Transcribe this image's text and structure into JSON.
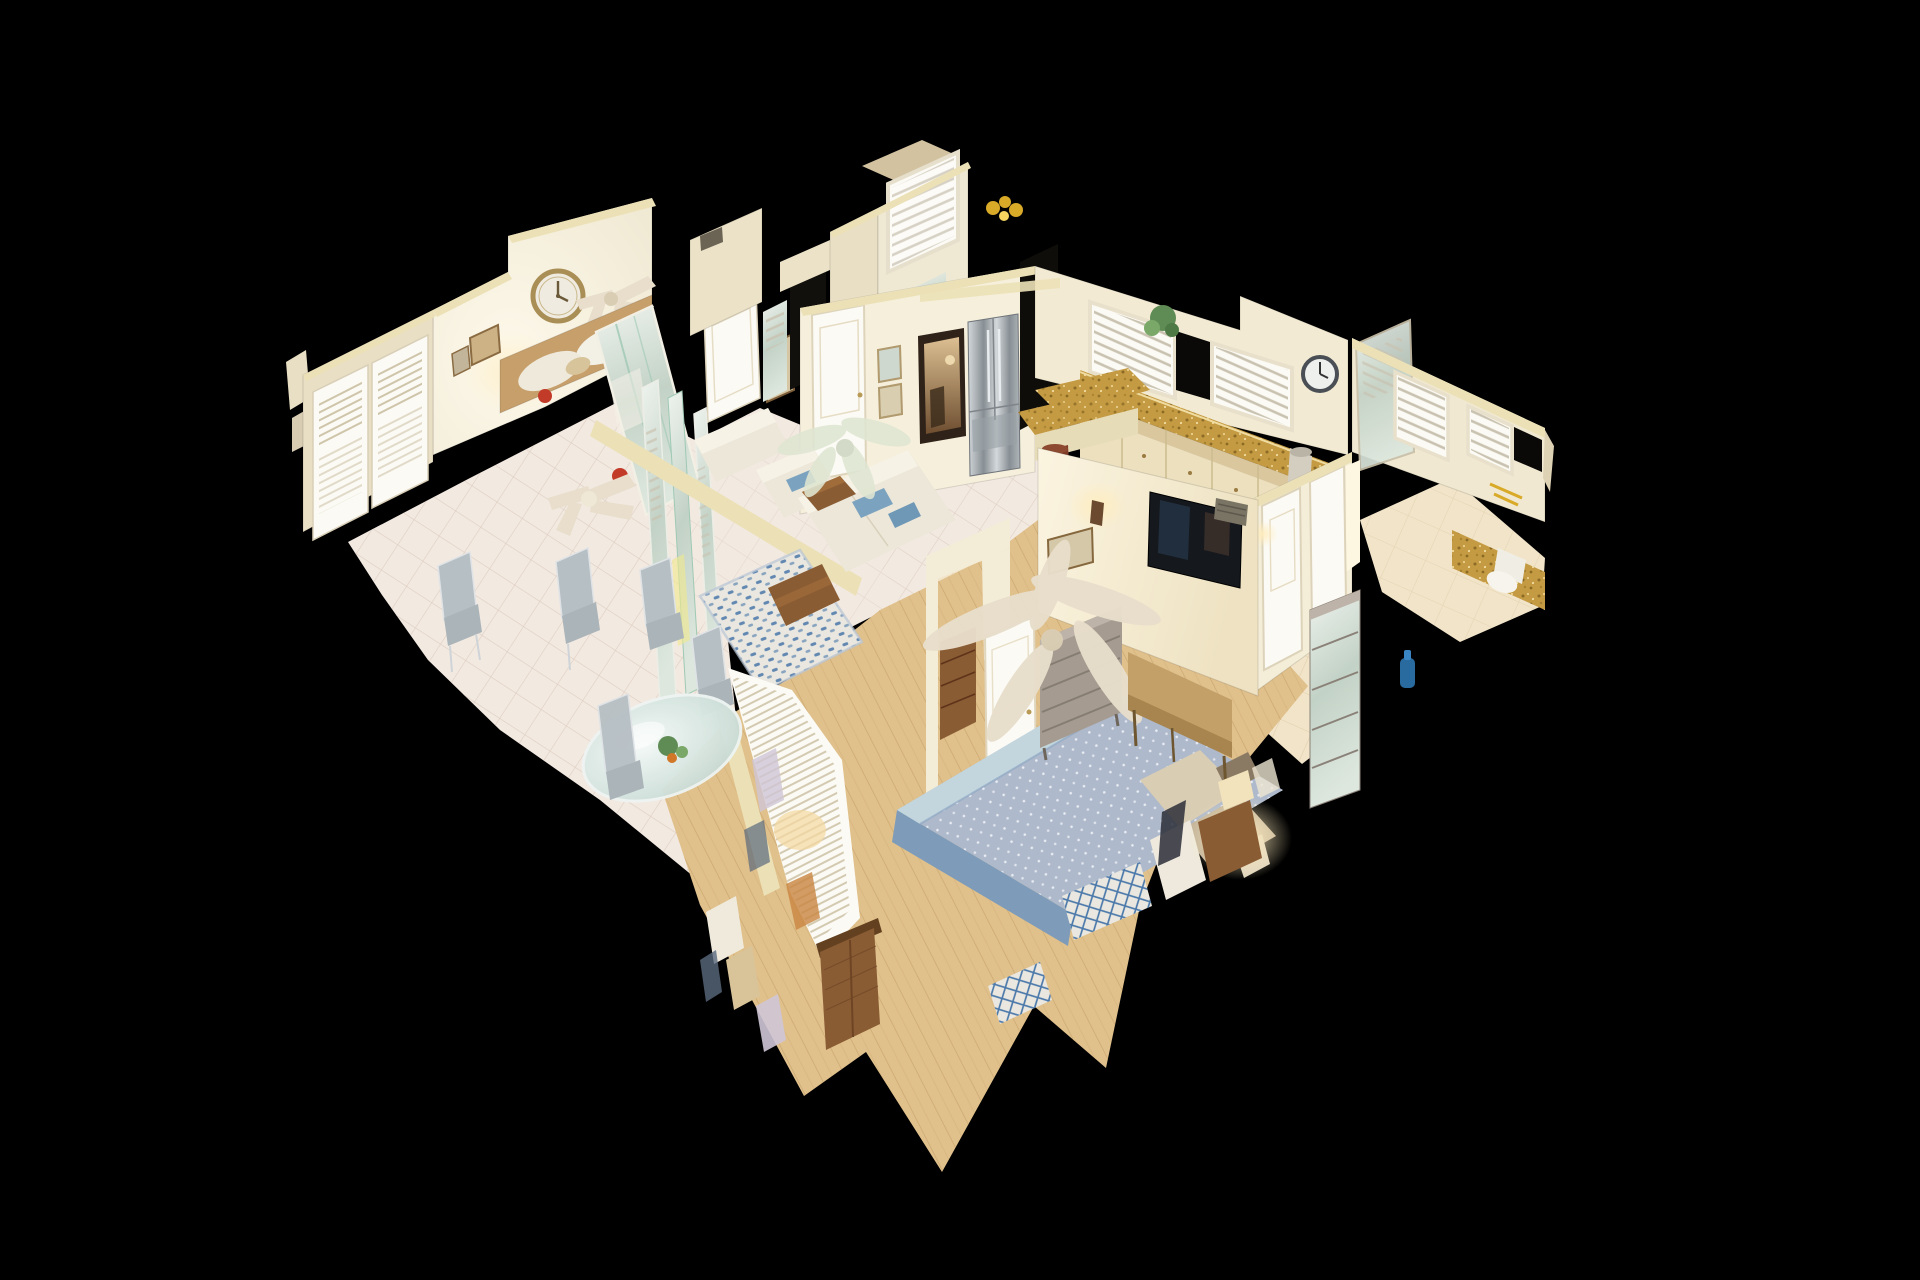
{
  "scene": {
    "label": "3D dollhouse cutaway view of a furnished condo scan on black background",
    "view_mode": "dollhouse",
    "rooms": [
      {
        "name": "guest-bedroom",
        "items": [
          "gold-rim-wall-clock",
          "ceiling-fan-fragment",
          "wood-headboard-with-pillows",
          "louvered-closet-doors",
          "mirrored-closet-panels",
          "framed-art",
          "white-door",
          "red-cardinal-ornament"
        ]
      },
      {
        "name": "dining-area",
        "items": [
          "glass-dining-table",
          "gray-dining-chairs",
          "tile-floor",
          "mirrored-wall-strips",
          "white-ceiling-fan",
          "red-cardinal-ornament"
        ]
      },
      {
        "name": "living-room",
        "items": [
          "white-sofa",
          "white-loveseat",
          "white-armchair",
          "blue-throw-pillows",
          "wood-coffee-table",
          "wood-side-table",
          "blue-pattern-area-rug",
          "glass-ceiling-fan"
        ]
      },
      {
        "name": "entry-hall",
        "items": [
          "white-door",
          "framed-beach-art",
          "ornate-framed-mirror",
          "stainless-french-door-refrigerator",
          "dark-doorway"
        ]
      },
      {
        "name": "guest-bathroom",
        "items": [
          "plantation-shutter-window",
          "vanity-mirror",
          "gold-glassware"
        ]
      },
      {
        "name": "kitchen",
        "items": [
          "plantation-shutter-windows",
          "potted-plant",
          "wall-clock",
          "granite-countertop",
          "cream-cabinets",
          "granite-breakfast-bar",
          "wood-bar-stool",
          "trash-can"
        ]
      },
      {
        "name": "master-bedroom",
        "items": [
          "bed-with-blue-diamond-quilt",
          "blue-bed-skirt",
          "beige-ceiling-fan",
          "weathered-gray-dresser",
          "tan-upholstered-bench",
          "wall-mounted-tv",
          "wall-sconce",
          "air-vent",
          "framed-art",
          "nightstand-with-lamp",
          "wicker-armoire",
          "trellis-rug-fragments",
          "torn-plantation-shutters",
          "wood-plank-floor",
          "white-door",
          "brown-chest-through-doorway"
        ]
      },
      {
        "name": "hallway",
        "items": [
          "white-doors",
          "tall-gray-cabinet",
          "beige-tile-floor",
          "wall-sconce"
        ]
      },
      {
        "name": "master-bathroom",
        "items": [
          "plantation-shutter-windows",
          "shower-glass-panel",
          "granite-vanity",
          "toilet",
          "gold-fixture",
          "blue-water-jug"
        ]
      }
    ]
  },
  "palette": {
    "bg": "#000000",
    "void": "#0d0b08",
    "wall": "#f5efdd",
    "wall_shadow": "#e9dfc4",
    "wall_cap": "#ece1b6",
    "wall_warm": "#fbf4e0",
    "tile": "#f2e9e1",
    "tile_line": "#dccbbd",
    "hall_tile": "#f1e4c9",
    "hall_tile_line": "#ddc9a3",
    "wood": "#e0c08b",
    "wood_line": "#c49f66",
    "granite": "#c49a42",
    "granite_dark": "#8a6a24",
    "granite_light": "#f0dca0",
    "cabinet": "#ece0bf",
    "cabinet_line": "#cdbc8e",
    "steel_hi": "#d3d8db",
    "steel_lo": "#888f94",
    "sofa": "#ece7d8",
    "sofa_hi": "#f6f2e6",
    "pillow_blue": "#7ba3bf",
    "rug_base": "#e9e7df",
    "rug_blue": "#4a78aa",
    "quilt": "#aeb9cb",
    "quilt_dot": "#e9edf3",
    "quilt_fold": "#c3d6de",
    "bed_skirt": "#7e9cba",
    "bench": "#c2a067",
    "bench_dark": "#a8854e",
    "dresser_gray": "#a59b90",
    "dresser_line": "#857c72",
    "wood_dark": "#8a5c34",
    "wood_darker": "#63401f",
    "mirror_hi": "#eef3ee",
    "mirror_lo": "#c3d2c6",
    "glass_hi": "#f4faf8",
    "glass_lo": "#bdd2cc",
    "shutter": "#fbfaf4",
    "slat": "#c9c2b0",
    "louver": "#cfc5aa",
    "clock_gold": "#a98e55",
    "clock_rim_dark": "#4a4f55",
    "fan_beige": "#e8decb",
    "fan_glass": "#dfe6d2",
    "red_accent": "#c23a28",
    "plant_green": "#5f8b55",
    "gold": "#d9a928",
    "glow": "#ffedbe",
    "tv": "#15181d",
    "chair_gray": "#b6bfc4",
    "chrome": "#dfe3e6"
  }
}
